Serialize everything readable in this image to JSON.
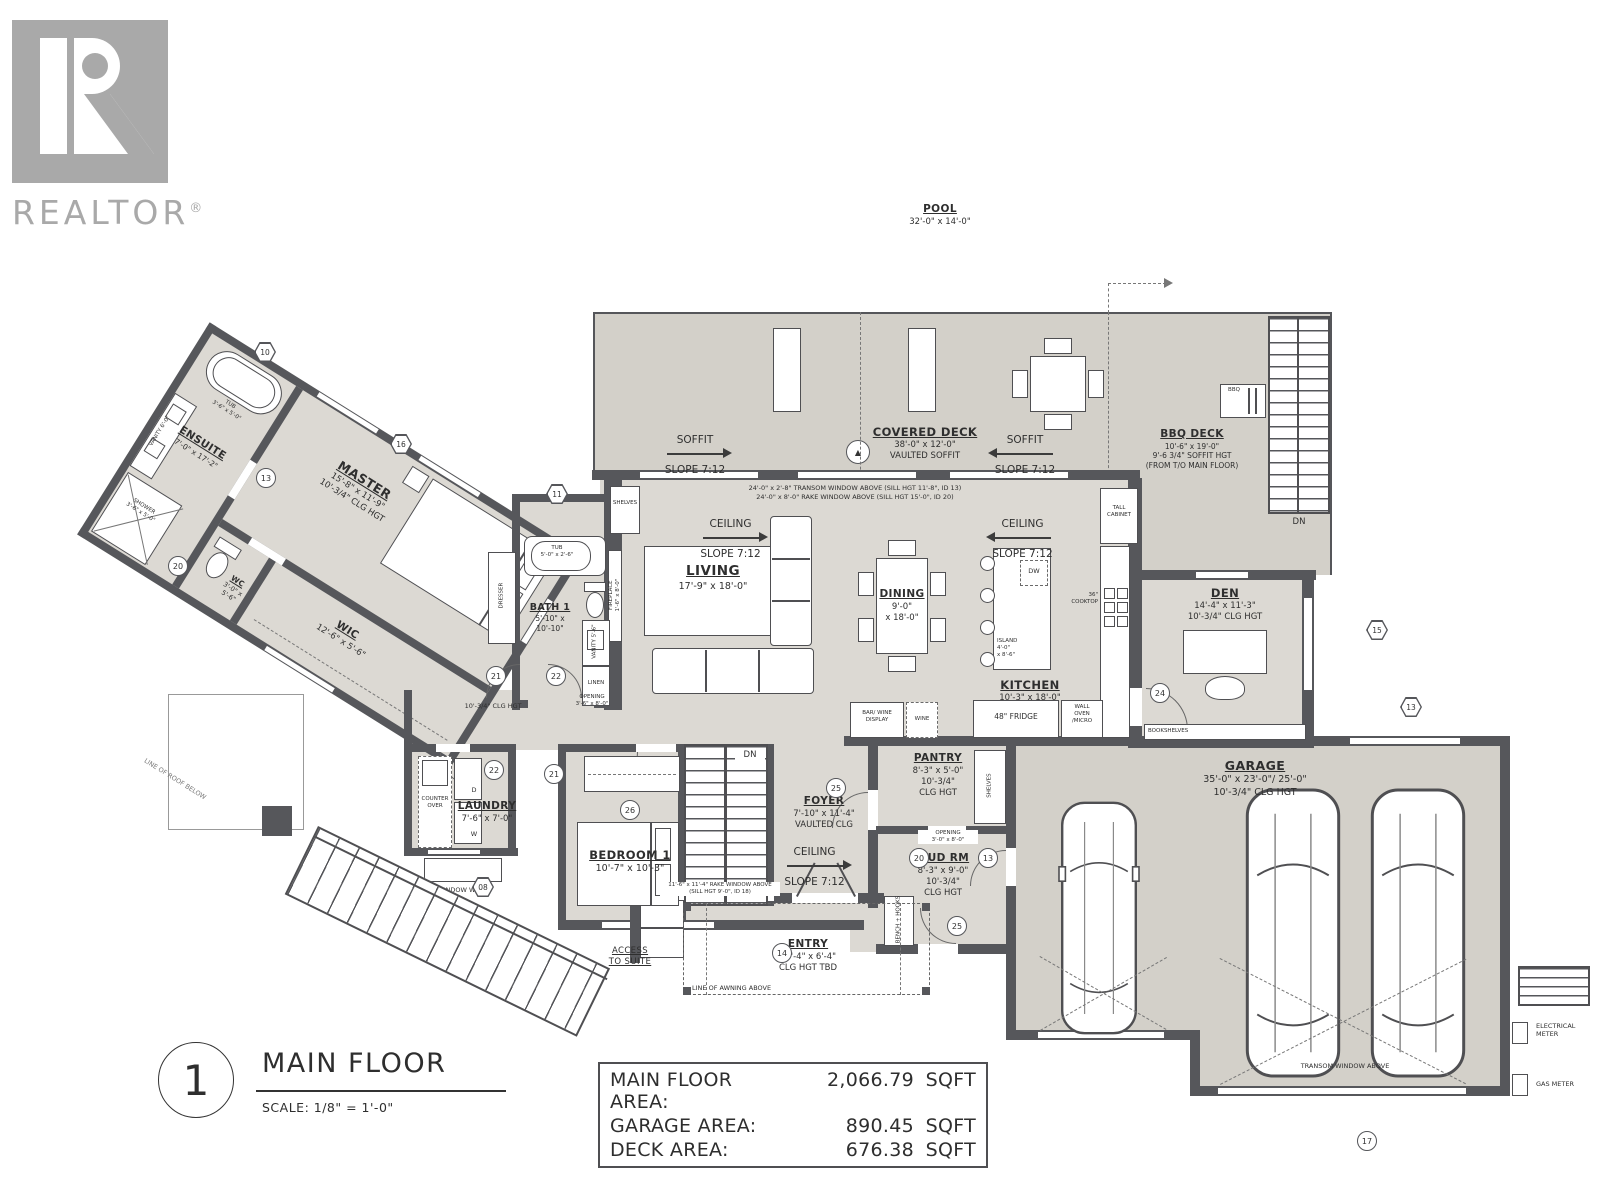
{
  "logo": {
    "brand": "REALTOR",
    "reg": "®"
  },
  "pool": {
    "name": "POOL",
    "dims": "32'-0\" x 14'-0\""
  },
  "deck": {
    "soffit": "SOFFIT",
    "slope": "SLOPE 7:12",
    "covered": {
      "name": "COVERED DECK",
      "dims": "38'-0\" x 12'-0\"",
      "note": "VAULTED SOFFIT"
    },
    "bbq_deck": {
      "name": "BBQ DECK",
      "dims": "10'-6\" x 19'-0\"",
      "note1": "9'-6 3/4\" SOFFIT HGT",
      "note2": "(FROM T/O MAIN FLOOR)"
    },
    "bbq": "BBQ",
    "dn": "DN"
  },
  "ceiling": {
    "name": "CEILING",
    "slope": "SLOPE 7:12"
  },
  "rooms": {
    "living": {
      "name": "LIVING",
      "dims": "17'-9\" x 18'-0\""
    },
    "dining": {
      "name": "DINING",
      "d1": "9'-0\"",
      "d2": "x 18'-0\""
    },
    "kitchen": {
      "name": "KITCHEN",
      "dims": "10'-3\" x 18'-0\""
    },
    "den": {
      "name": "DEN",
      "dims": "14'-4\" x 11'-3\"",
      "note": "10'-3/4\" CLG HGT"
    },
    "master": {
      "name": "MASTER",
      "dims": "15'-8\" x 11'-9\"",
      "note": "10'-3/4\" CLG HGT"
    },
    "ensuite": {
      "name": "ENSUITE",
      "dims": "7'-0\" x 17'-2\""
    },
    "wc": {
      "name": "WC",
      "d1": "3'-0\" x",
      "d2": "5'-6\""
    },
    "wic": {
      "name": "WIC",
      "dims": "12'-6\" x 5'-6\""
    },
    "bath1": {
      "name": "BATH 1",
      "d1": "5'-10\" x",
      "d2": "10'-10\""
    },
    "laundry": {
      "name": "LAUNDRY",
      "dims": "7'-6\" x 7'-0\""
    },
    "bedroom1": {
      "name": "BEDROOM 1",
      "dims": "10'-7\" x 10'-3\""
    },
    "foyer": {
      "name": "FOYER",
      "dims": "7'-10\" x 11'-4\"",
      "note": "VAULTED CLG"
    },
    "pantry": {
      "name": "PANTRY",
      "dims": "8'-3\" x 5'-0\"",
      "n1": "10'-3/4\"",
      "n2": "CLG HGT"
    },
    "mudrm": {
      "name": "MUD RM",
      "dims": "8'-3\" x 9'-0\"",
      "n1": "10'-3/4\"",
      "n2": "CLG HGT"
    },
    "entry": {
      "name": "ENTRY",
      "dims": "14'-4\" x 6'-4\"",
      "note": "CLG HGT TBD"
    },
    "garage": {
      "name": "GARAGE",
      "dims": "35'-0\" x 23'-0\"/ 25'-0\"",
      "note": "10'-3/4\" CLG HGT"
    }
  },
  "fix": {
    "tub": "TUB",
    "tub_ens_dims": "3'-6\" x 5'-0\"",
    "tub_b1_dims": "5'-0\" x 2'-6\"",
    "shower": "SHOWER",
    "shower_dims": "3'-6\" x 5'-0\"",
    "vanity_ens": "VANITY 6'-0\"",
    "vanity_b1": "VANITY 5'-6\"",
    "dresser": "DRESSER",
    "linen": "LINEN",
    "shelves": "SHELVES",
    "fireplace": "FIREPLACE",
    "fireplace_dims": "1'-6\" x 8'-0\"",
    "island": "ISLAND",
    "island_d1": "4'-0\"",
    "island_d2": "x 8'-6\"",
    "dw": "DW",
    "tall1": "TALL",
    "tall2": "CABINET",
    "cook1": "36\"",
    "cook2": "COOKTOP",
    "bar1": "BAR/ WINE",
    "bar2": "DISPLAY",
    "wine": "WINE",
    "fridge": "48\" FRIDGE",
    "oven1": "WALL",
    "oven2": "OVEN",
    "oven3": "/MICRO",
    "bookshelves": "BOOKSHELVES",
    "bench": "BENCH + HOOKS",
    "counter1": "COUNTER",
    "counter2": "OVER",
    "d": "D",
    "w": "W",
    "window_well": "WINDOW WELL",
    "dn": "DN"
  },
  "notes": {
    "transom1": "24'-0\" x 2'-8\" TRANSOM WINDOW ABOVE (SILL HGT 11'-8\", ID 13)",
    "transom2": "24'-0\" x 8'-0\" RAKE WINDOW ABOVE (SILL HGT 15'-0\", ID 20)",
    "rake1": "11'-6\" x 11'-4\" RAKE WINDOW ABOVE",
    "rake2": "(SILL HGT 9'-0\", ID 18)",
    "awning": "LINE OF AWNING ABOVE",
    "transom_g": "TRANSOM WINDOW ABOVE",
    "elec1": "ELECTRICAL",
    "elec2": "METER",
    "gas": "GAS METER",
    "access1": "ACCESS",
    "access2": "TO SUITE",
    "hall": "10'-3/4\" CLG HGT",
    "open1": "OPENING",
    "open1d": "3'-6\" x 8'-0\"",
    "open2": "OPENING",
    "open2d": "3'-0\" x 8'-0\"",
    "roof": "LINE OF ROOF BELOW"
  },
  "markers": {
    "m08": "08",
    "m10": "10",
    "m11": "11",
    "m13": "13",
    "m14": "14",
    "m15": "15",
    "m16": "16",
    "m17": "17",
    "m20": "20",
    "m21": "21",
    "m22": "22",
    "m24": "24",
    "m25": "25",
    "m26": "26"
  },
  "title_block": {
    "number": "1",
    "title": "MAIN FLOOR",
    "scale": "SCALE: 1/8\"  =   1'-0\""
  },
  "area_table": [
    {
      "label": "MAIN FLOOR AREA:",
      "value": "2,066.79",
      "unit": "SQFT"
    },
    {
      "label": "GARAGE AREA:",
      "value": "890.45",
      "unit": "SQFT"
    },
    {
      "label": "DECK AREA:",
      "value": "676.38",
      "unit": "SQFT"
    }
  ]
}
